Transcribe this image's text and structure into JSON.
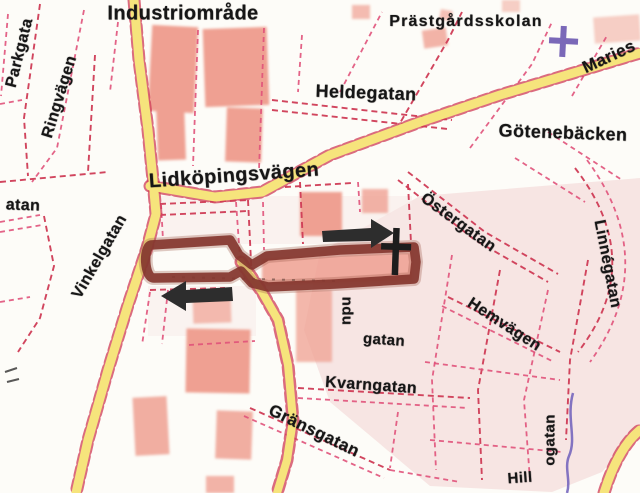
{
  "map": {
    "area_labels": {
      "industriomrade": "Industriområde",
      "prastgardsskolan": "Prästgårdsskolan",
      "gotenebacken": "Götenebäcken"
    },
    "street_labels": {
      "lidkopingsvagen": "Lidköpingsvägen",
      "heldegatan": "Heldegatan",
      "ringvagen": "Ringvägen",
      "parkgatan_partial": "Parkgata",
      "vinkelgatan": "Vinkelgatan",
      "ostergatan": "Östergatan",
      "linnegatan": "Linnégatan",
      "hemvagen": "Hemvägen",
      "kvarngatan": "Kvarngatan",
      "gransgatan": "Gränsgatan",
      "mariestadsvagen_partial": "Maries",
      "gatan_west_partial": "atan",
      "industrigatan_vertical_partial": "ndu",
      "industrigatan_horizontal_partial": "gatan",
      "hillogatan_horizontal_partial": "Hill",
      "hillogatan_vertical_partial": "ogatan"
    },
    "symbols": {
      "direction_arrow_east": "right-arrow",
      "direction_arrow_west": "left-arrow",
      "route_end_marker": "plus-cross",
      "church_symbol": "cross"
    },
    "colors": {
      "background": "#fdfcf8",
      "route": "#84362f",
      "road_fill": "#f6e47c",
      "street_casing": "#e0527a",
      "street_casing_dark": "#cf3b55",
      "building": "#efa092",
      "block_tint": "#f3dcda",
      "block_tint_light": "#f8e9e7",
      "creek": "#6f5fbb",
      "arrow": "#2d2d2d",
      "marker": "#1d1d1d",
      "church_cross": "#7a68b8",
      "label_ink": "#161616"
    }
  }
}
